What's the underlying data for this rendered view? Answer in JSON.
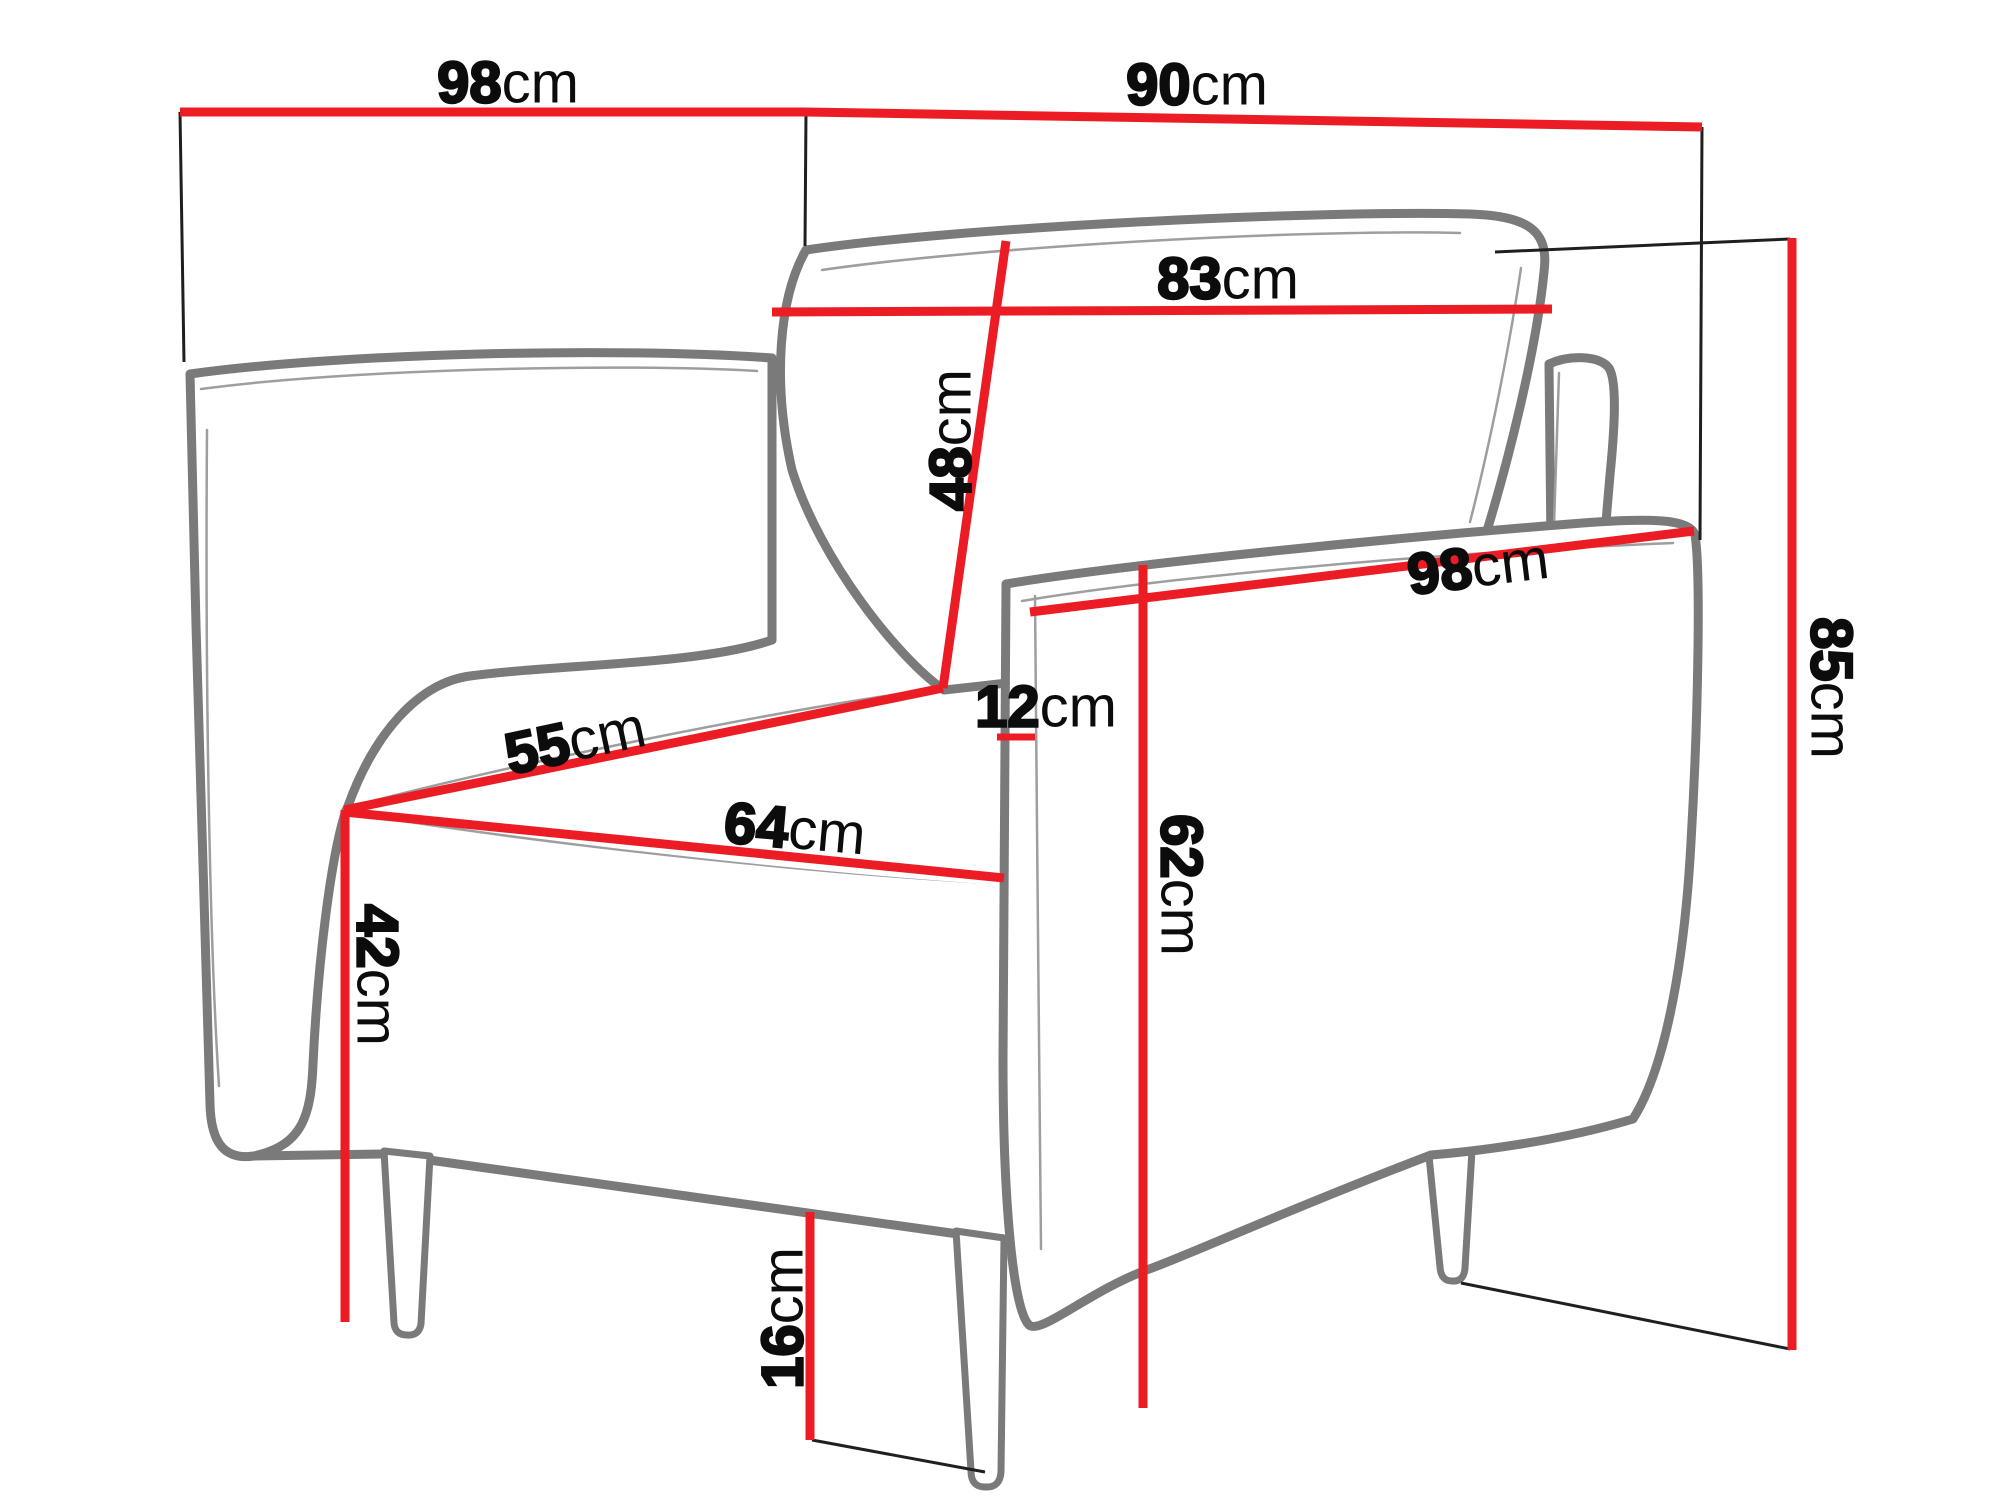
{
  "diagram": {
    "kind": "furniture-dimension-diagram",
    "subject": "armchair",
    "unit": "cm",
    "colors": {
      "dimension_red": "#ec1c24",
      "helper_black": "#1f1f1f",
      "artwork_gray": "#7a7a7a",
      "label_text": "#0c0c0c",
      "background": "#ffffff"
    },
    "measurements_cm": [
      98,
      90,
      83,
      48,
      98,
      12,
      55,
      64,
      62,
      42,
      85,
      16
    ],
    "labels": [
      {
        "id": "dim-98-depth-top",
        "num": "98",
        "unit": "cm",
        "x": 508,
        "y": 82,
        "rotate": 0
      },
      {
        "id": "dim-90-width-top",
        "num": "90",
        "unit": "cm",
        "x": 1197,
        "y": 84,
        "rotate": 0
      },
      {
        "id": "dim-83-backrest-width",
        "num": "83",
        "unit": "cm",
        "x": 1228,
        "y": 278,
        "rotate": 0
      },
      {
        "id": "dim-48-backrest-height",
        "num": "48",
        "unit": "cm",
        "x": 950,
        "y": 440,
        "rotate": -90
      },
      {
        "id": "dim-98-armrest-length",
        "num": "98",
        "unit": "cm",
        "x": 1478,
        "y": 566,
        "rotate": -7
      },
      {
        "id": "dim-12-armrest-width",
        "num": "12",
        "unit": "cm",
        "x": 1046,
        "y": 706,
        "rotate": 0
      },
      {
        "id": "dim-55-seat-depth",
        "num": "55",
        "unit": "cm",
        "x": 575,
        "y": 740,
        "rotate": -12
      },
      {
        "id": "dim-64-seat-width",
        "num": "64",
        "unit": "cm",
        "x": 795,
        "y": 828,
        "rotate": 5
      },
      {
        "id": "dim-62-armrest-height",
        "num": "62",
        "unit": "cm",
        "x": 1182,
        "y": 885,
        "rotate": 90
      },
      {
        "id": "dim-42-seat-height",
        "num": "42",
        "unit": "cm",
        "x": 378,
        "y": 975,
        "rotate": 90
      },
      {
        "id": "dim-85-total-height",
        "num": "85",
        "unit": "cm",
        "x": 1832,
        "y": 688,
        "rotate": 90
      },
      {
        "id": "dim-16-leg-height",
        "num": "16",
        "unit": "cm",
        "x": 782,
        "y": 1318,
        "rotate": -90
      }
    ],
    "red_lines": [
      {
        "id": "line-98-top",
        "pts": [
          180,
          112,
          806,
          112
        ],
        "w": 9
      },
      {
        "id": "line-90-top",
        "pts": [
          806,
          112,
          1702,
          127
        ],
        "w": 9
      },
      {
        "id": "line-83",
        "pts": [
          772,
          312,
          1552,
          309
        ],
        "w": 9
      },
      {
        "id": "line-48",
        "pts": [
          1006,
          241,
          943,
          688
        ],
        "w": 9
      },
      {
        "id": "line-55",
        "pts": [
          344,
          810,
          943,
          688
        ],
        "w": 9
      },
      {
        "id": "line-64",
        "pts": [
          344,
          812,
          1004,
          878
        ],
        "w": 9
      },
      {
        "id": "line-42",
        "pts": [
          345,
          810,
          345,
          1322
        ],
        "w": 9
      },
      {
        "id": "line-98-armrest",
        "pts": [
          1030,
          612,
          1694,
          531
        ],
        "w": 9
      },
      {
        "id": "line-12-tick",
        "pts": [
          997,
          737,
          1035,
          737
        ],
        "w": 7
      },
      {
        "id": "line-62",
        "pts": [
          1143,
          565,
          1143,
          1408
        ],
        "w": 9
      },
      {
        "id": "line-85",
        "pts": [
          1792,
          238,
          1792,
          1350
        ],
        "w": 9
      },
      {
        "id": "line-16",
        "pts": [
          810,
          1212,
          810,
          1440
        ],
        "w": 9
      }
    ],
    "black_lines": [
      {
        "id": "ext-left-vertical",
        "pts": [
          180,
          112,
          184,
          362
        ],
        "w": 3
      },
      {
        "id": "ext-mid-vertical",
        "pts": [
          806,
          112,
          805,
          246
        ],
        "w": 3
      },
      {
        "id": "ext-right-vertical",
        "pts": [
          1702,
          127,
          1700,
          540
        ],
        "w": 3
      },
      {
        "id": "ext-top-diagonal",
        "pts": [
          1495,
          252,
          1790,
          239
        ],
        "w": 3
      },
      {
        "id": "ext-bottom-diagonal",
        "pts": [
          1461,
          1283,
          1790,
          1349
        ],
        "w": 3
      },
      {
        "id": "floor-line-16",
        "pts": [
          812,
          1440,
          985,
          1472
        ],
        "w": 3
      }
    ]
  }
}
